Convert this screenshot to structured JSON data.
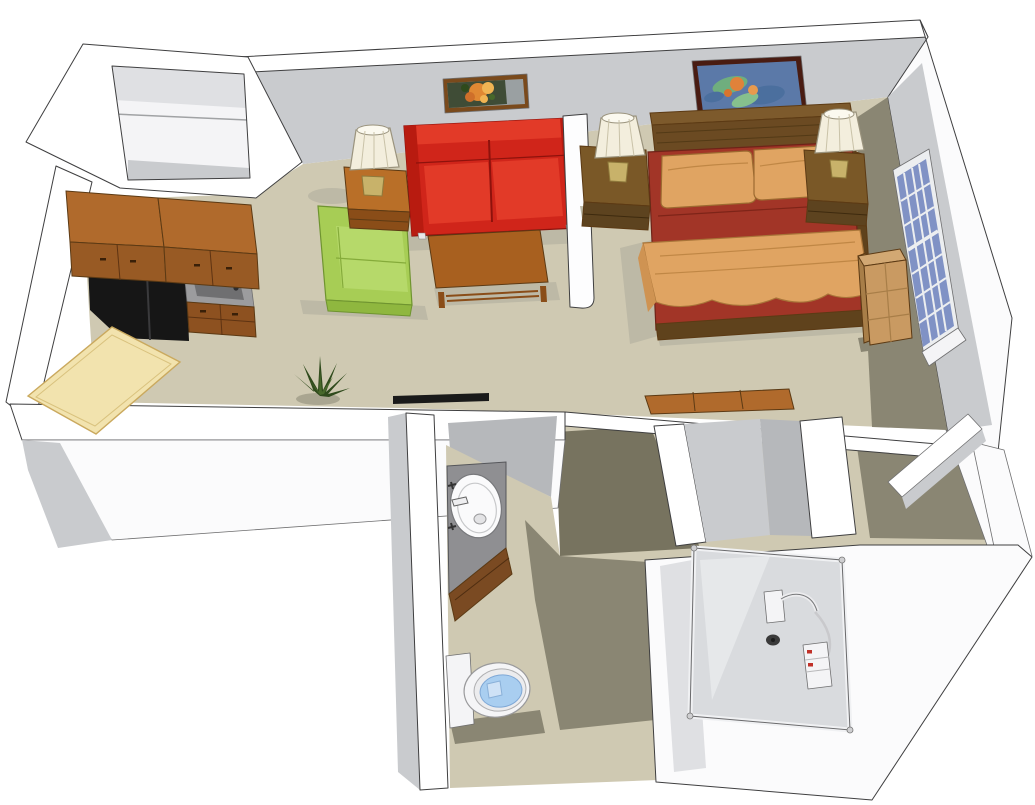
{
  "meta": {
    "title": "3D cutaway floor plan of a studio apartment",
    "render_style": "isometric sketch render, top-down cutaway walls",
    "canvas": {
      "width": 1035,
      "height": 805
    }
  },
  "scene": {
    "rooms": [
      {
        "name": "entry-closet",
        "items": [
          "shelf"
        ]
      },
      {
        "name": "kitchen",
        "items": [
          "upper-cabinets",
          "refrigerator",
          "sink-counter",
          "lower-cabinets",
          "dining-table"
        ]
      },
      {
        "name": "living-area",
        "items": [
          "green-armchair",
          "end-table",
          "table-lamp",
          "red-loveseat",
          "coffee-table",
          "flower-painting",
          "potted-plant"
        ]
      },
      {
        "name": "bedroom",
        "items": [
          "double-bed",
          "headboard",
          "maroon-comforter",
          "tan-pillows",
          "tan-throw-blanket",
          "nightstand-left",
          "nightstand-right",
          "table-lamp-left",
          "table-lamp-right",
          "impressionist-painting",
          "paned-window",
          "bookshelf"
        ]
      },
      {
        "name": "bedroom-closet",
        "items": [
          "dresser"
        ]
      },
      {
        "name": "linen-closet",
        "items": [
          "shelf"
        ]
      },
      {
        "name": "bathroom",
        "items": [
          "vanity-sink",
          "faucet",
          "toilet",
          "sliding-door-track"
        ]
      },
      {
        "name": "shower-room",
        "items": [
          "glass-enclosure",
          "shower-head",
          "shower-caddy",
          "floor-drain"
        ]
      }
    ]
  },
  "palette": {
    "bg": "#ffffff",
    "floor": "#cfc9b2",
    "floor_shadow": "#bdb9a6",
    "floor_shadow_olive": "#8a8673",
    "floor_shadow_dark": "#77735f",
    "wall_top": "#ffffff",
    "wall_white": "#fbfbfc",
    "wall_face": "#c9cbce",
    "wall_face_light": "#dfe0e3",
    "wall_face_dark": "#b6b8bb",
    "wall_inner_pale": "#f4f4f6",
    "track_black": "#1a1a1a",
    "cab_top": "#b06a2c",
    "cab_front": "#985a24",
    "cab_front_dark": "#8d5120",
    "counter_gray": "#9c9c9e",
    "sink_gray": "#6f6f71",
    "fridge_black": "#161616",
    "fridge_hi": "#303032",
    "table_yellow": "#f2e3ae",
    "table_yellow_edge": "#d9c27e",
    "chair_green": "#a7cd55",
    "chair_green_light": "#b6d96a",
    "chair_green_dark": "#8fb73f",
    "sofa_red": "#d0251a",
    "sofa_red_light": "#e23a28",
    "sofa_red_dark": "#b81b10",
    "sofa_crease": "#8e120c",
    "wood_mid": "#a8601f",
    "wood_mid_light": "#b96f28",
    "wood_mid_dark": "#8a4d18",
    "lamp_shade": "#f3eedd",
    "lamp_shade_line": "#c9c2a8",
    "lamp_base": "#c8b26a",
    "painting1_frame": "#7a4a1c",
    "painting1_bg_dark": "#3f4c36",
    "painting1_bg_light": "#9aa0a2",
    "flower_orange": "#e08833",
    "flower_orange_light": "#f0b453",
    "leaf_green": "#47682a",
    "plant_dark": "#2f4a1c",
    "divider_white": "#fdfdfe",
    "headboard_cap": "#7d5a2c",
    "headboard": "#6b4a22",
    "headboard_grain": "#533a16",
    "bed_wood": "#5f421c",
    "comforter": "#a23527",
    "comforter_dark": "#7e2418",
    "pillow": "#e0a462",
    "pillow_line": "#c08745",
    "throw_drape": "#cf9352",
    "nightstand_top": "#7a5827",
    "nightstand_front": "#5d431f",
    "painting2_frame": "#491c12",
    "painting2_bg": "#5b79a8",
    "p2_green": "#6fae7e",
    "p2_green_light": "#86c08d",
    "p2_blue": "#4b6f9e",
    "p2_orange": "#e0823a",
    "p2_orange_light": "#e89a4e",
    "window_frame": "#eceef0",
    "window_glass": "#8092c5",
    "shelf_top": "#d2a873",
    "shelf_front": "#c99a62",
    "shelf_side": "#a87e48",
    "vanity_gray": "#8f8f92",
    "vanity_wood": "#7a4a22",
    "porcelain": "#f4f4f6",
    "porcelain_dim": "#ececee",
    "water": "#a9cef0",
    "water_edge": "#7fa8d6",
    "glass_fill": "#d9dbde",
    "glass_sheen": "#e6e8ea",
    "rail_white": "#f0f1f3",
    "chrome_gray": "#c9c9cc",
    "caddy_red": "#c03028",
    "drain": "#3a3a3a"
  }
}
